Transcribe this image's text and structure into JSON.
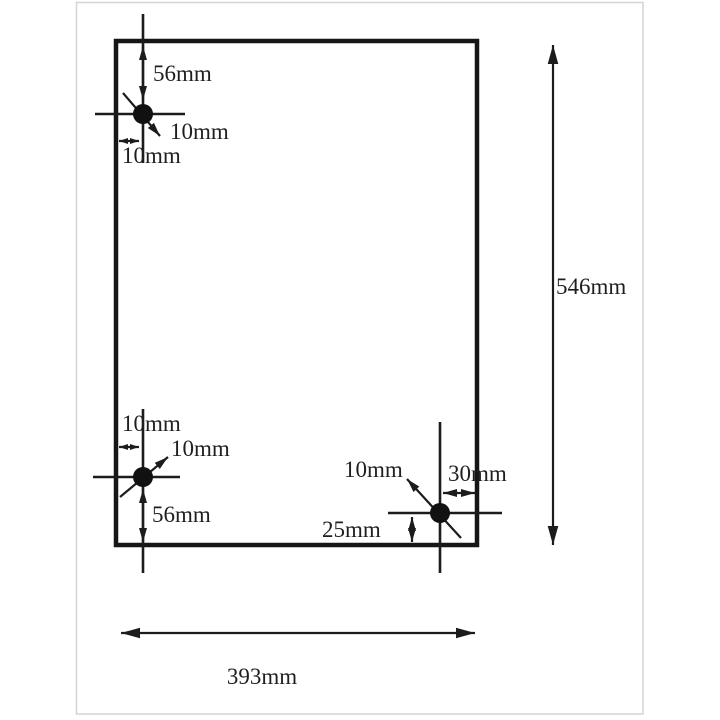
{
  "diagram": {
    "type": "technical-drawing",
    "subject": "panel drilling template with three hole positions",
    "panel": {
      "width_label": "393mm",
      "height_label": "546mm"
    },
    "holes": {
      "top_left": {
        "from_top": "56mm",
        "diameter": "10mm",
        "from_left": "10mm"
      },
      "bottom_left": {
        "from_left": "10mm",
        "diameter": "10mm",
        "from_bottom": "56mm"
      },
      "bottom_right": {
        "diameter": "10mm",
        "from_right": "30mm",
        "from_bottom": "25mm"
      }
    },
    "colors": {
      "line": "#1c1c1c",
      "text": "#1f1f1f",
      "hole_fill": "#111111",
      "frame_border": "#d4d4d4",
      "background": "#ffffff"
    }
  }
}
